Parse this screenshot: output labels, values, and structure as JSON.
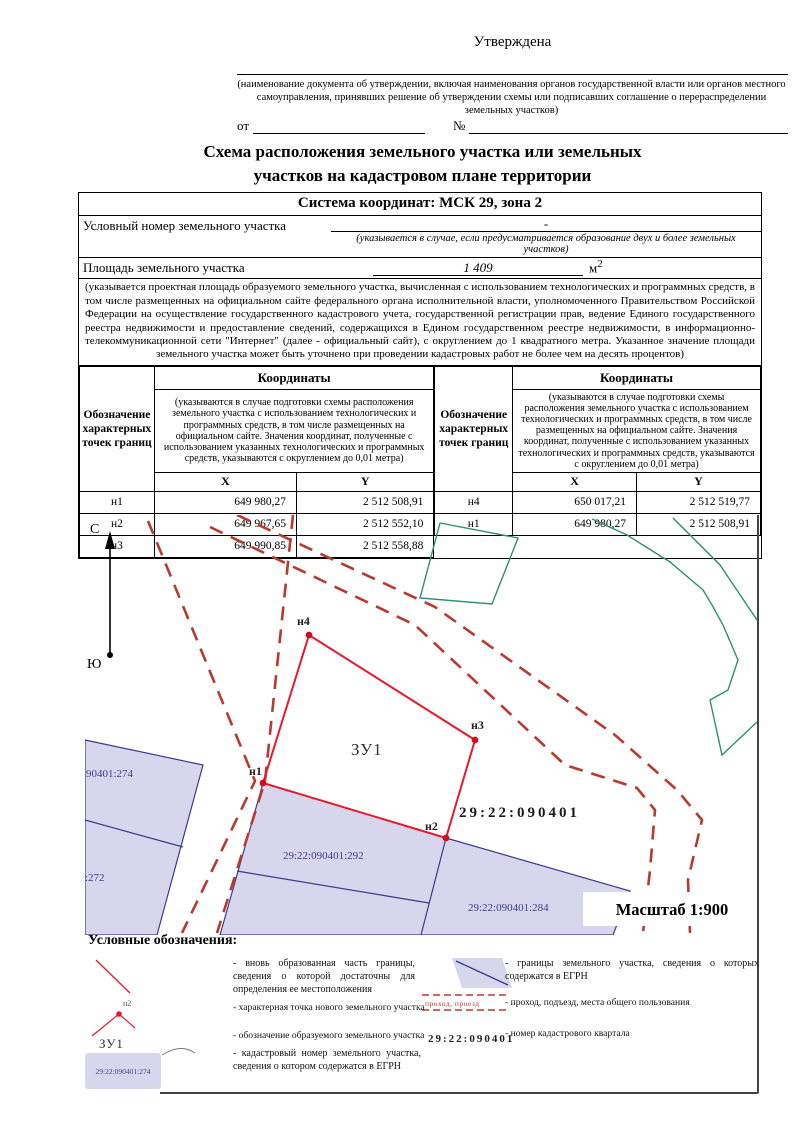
{
  "approval": {
    "approved_label": "Утверждена",
    "caption": "(наименование документа об утверждении, включая наименования органов государственной власти или органов местного самоуправления, принявших решение об утверждении схемы или подписавших соглашение о перераспределении земельных участков)",
    "from_label": "от",
    "number_label": "№"
  },
  "title": {
    "line1": "Схема расположения земельного участка или земельных",
    "line2": "участков на кадастровом плане территории"
  },
  "info": {
    "coord_system": "Система координат: МСК 29, зона 2",
    "conditional_number_label": "Условный номер земельного участка",
    "conditional_number_value": "-",
    "conditional_number_note": "(указывается в случае, если предусматривается образование двух и более земельных участков)",
    "area_label": "Площадь земельного участка",
    "area_value": "1 409",
    "area_unit": "м",
    "area_unit_sup": "2",
    "area_note": "(указывается проектная площадь образуемого земельного участка, вычисленная с использованием технологических и программных средств, в том числе размещенных на официальном сайте федерального органа исполнительной власти, уполномоченного Правительством Российской Федерации на осуществление государственного кадастрового учета, государственной регистрации прав, ведение Единого государственного реестра недвижимости и предоставление сведений, содержащихся в Едином государственном реестре недвижимости, в информационно-телекоммуникационной сети \"Интернет\" (далее - официальный сайт), с округлением до 1 квадратного метра. Указанное значение площади земельного участка может быть уточнено при проведении кадастровых работ не более чем на десять процентов)"
  },
  "coords_table": {
    "designation_header": "Обозначение характерных точек границ",
    "coordinates_header": "Координаты",
    "coordinates_note": "(указываются в случае подготовки схемы расположения земельного участка с использованием технологических и программных средств, в том числе размещенных на официальном сайте. Значения координат, полученные с использованием указанных технологических и программных средств, указываются с округлением до 0,01 метра)",
    "x_header": "X",
    "y_header": "Y",
    "left_rows": [
      [
        "н1",
        "649 980,27",
        "2 512 508,91"
      ],
      [
        "н2",
        "649 967,65",
        "2 512 552,10"
      ],
      [
        "н3",
        "649 990,85",
        "2 512 558,88"
      ]
    ],
    "right_rows": [
      [
        "н4",
        "650 017,21",
        "2 512 519,77"
      ],
      [
        "н1",
        "649 980,27",
        "2 512 508,91"
      ]
    ]
  },
  "map": {
    "north_label": "С",
    "south_label": "Ю",
    "parcel_label": "ЗУ1",
    "quarter_label": "29:22:090401",
    "scale_label": "Масштаб 1:900",
    "point_labels": {
      "n1": "н1",
      "n2": "н2",
      "n3": "н3",
      "n4": "н4"
    },
    "parcel_numbers": {
      "p274": "90401:274",
      "p272": ":272",
      "p292": "29:22:090401:292",
      "p284": "29:22:090401:284"
    }
  },
  "legend": {
    "heading": "Условные обозначения:",
    "items": {
      "new_boundary": "- вновь образованная часть границы, сведения о которой достаточны для определения ее местоположения",
      "char_point": "- характерная точка нового земельного участка",
      "parcel_designation": "- обозначение образуемого земельного участка",
      "cadastral_number": "- кадастровый номер земельного участка, сведения о котором содержатся в ЕГРН",
      "egrn_boundaries": "- границы земельного участка, сведения о которых содержатся в ЕГРН",
      "passage": "- проход, подъезд, места общего пользования",
      "quarter_number": "- номер кадастрового квартала"
    },
    "symbols": {
      "char_point_label": "н2",
      "parcel_label": "ЗУ1",
      "cadastral_sample": "29:22:090401:274",
      "passage_text": "проход,  проезд",
      "quarter_sample": "29:22:090401"
    }
  },
  "colors": {
    "boundary_red": "#e8192c",
    "road_red": "#b83a2e",
    "parcel_fill": "#d8d6ec",
    "parcel_border": "#3b3a8c",
    "egrn_green": "#2e8f72",
    "cadastral_blue": "#3c3f8f"
  }
}
